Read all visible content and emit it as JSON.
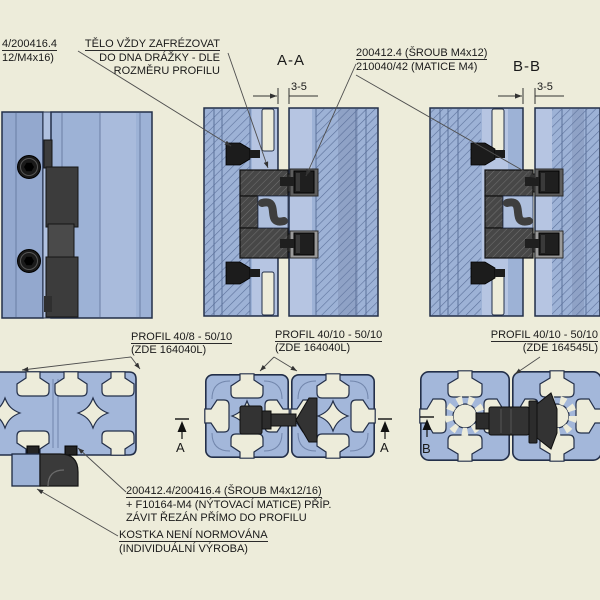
{
  "colors": {
    "background": "#EDECDA",
    "profile_blue": "#9DB2D6",
    "profile_light": "#B6C5E2",
    "dark_part": "#3E3E3E",
    "outline": "#232F49",
    "leader": "#4E4E4E",
    "text": "#1A1A1A"
  },
  "ann": {
    "top_left_note": {
      "line1": "4/200416.4",
      "line2": "12/M4x16)"
    },
    "body_note": {
      "line1": "TĚLO VŽDY ZAFRÉZOVAT",
      "line2": "DO DNA DRÁŽKY - DLE",
      "line3": "ROZMĚRU PROFILU"
    },
    "section_a": "A-A",
    "section_b": "B-B",
    "screw_note": {
      "line1": "200412.4 (ŠROUB M4x12)",
      "line2": "210040/42 (MATICE M4)"
    },
    "gap_dim_a": "3-5",
    "gap_dim_b": "3-5",
    "profile_left": {
      "line1": "PROFIL 40/8 - 50/10",
      "line2": "(ZDE 164040L)"
    },
    "profile_center": {
      "line1": "PROFIL 40/10 - 50/10",
      "line2": "(ZDE 164040L)"
    },
    "profile_right": {
      "line1": "PROFIL 40/10 - 50/10",
      "line2": "(ZDE 164545L)"
    },
    "fastener_note": {
      "line1": "200412.4/200416.4 (ŠROUB M4x12/16)",
      "line2": "+ F10164-M4 (NÝTOVACÍ MATICE) PŘÍP.",
      "line3": "ZÁVIT ŘEZÁN PŘÍMO DO PROFILU"
    },
    "block_note": {
      "line1": "KOSTKA NENÍ NORMOVÁNA",
      "line2": "(INDIVIDUÁLNÍ VÝROBA)"
    },
    "cut_a_left": "A",
    "cut_a_right": "A",
    "cut_b_left": "B"
  }
}
